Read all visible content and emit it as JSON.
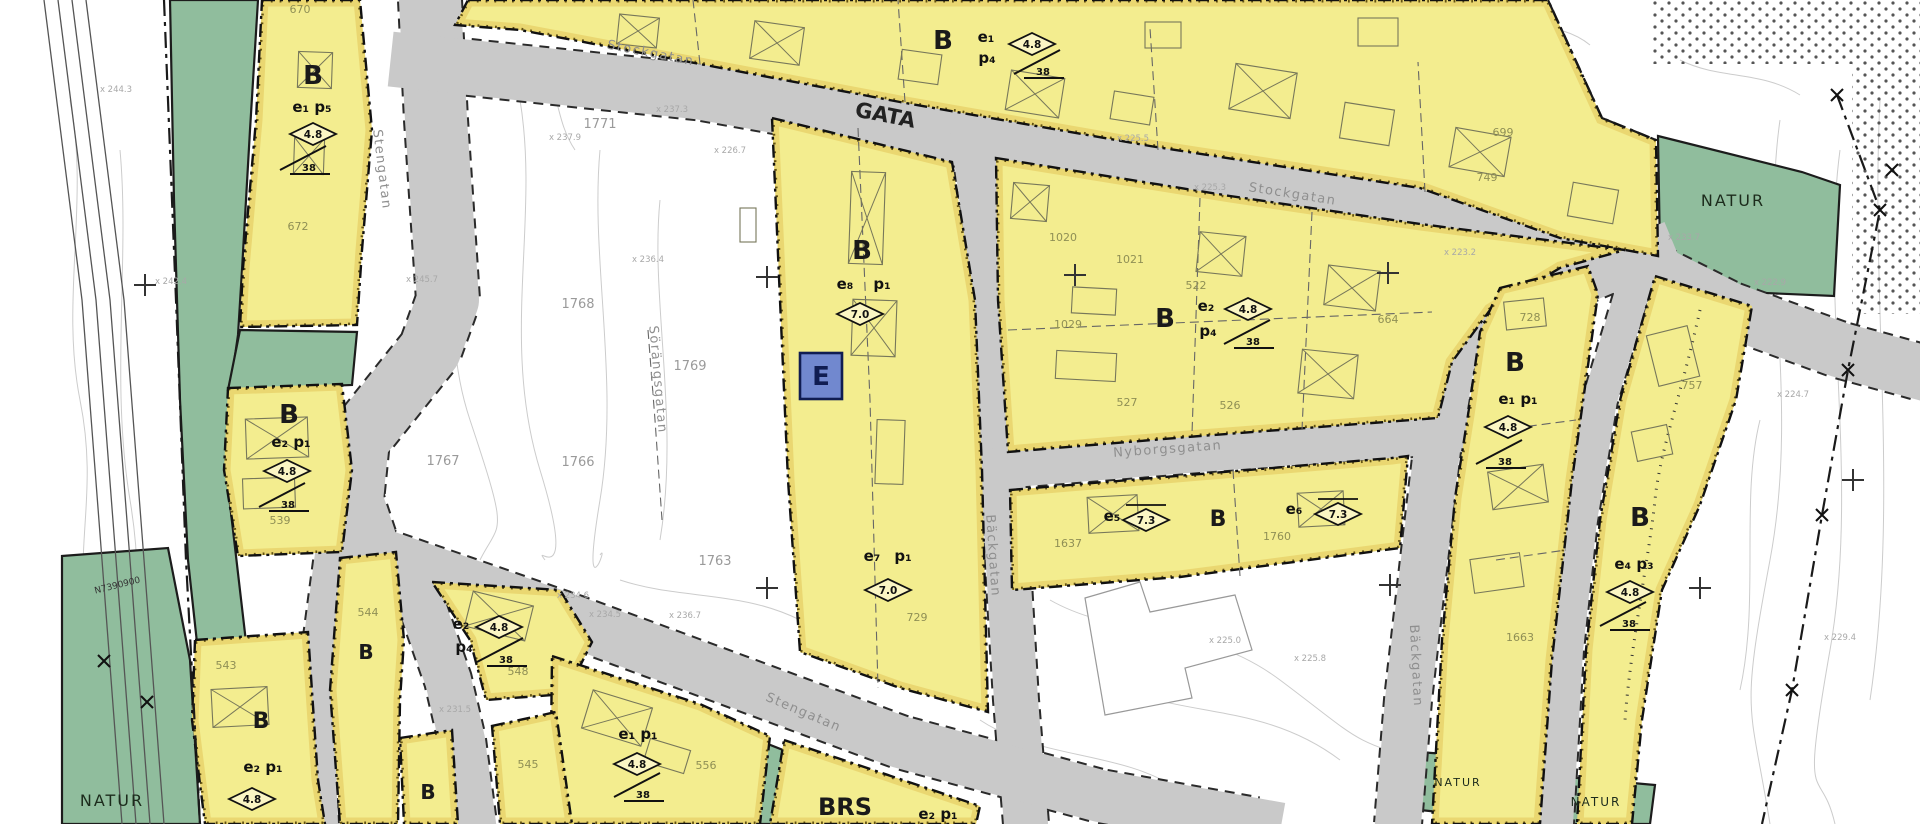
{
  "canvas": {
    "w": 1920,
    "h": 824,
    "bg": "#ffffff"
  },
  "palette": {
    "residential": "#f3ed8f",
    "nature": "#90bd9d",
    "road": "#c9c9c9",
    "road_edge": "#2a2a2a",
    "zone_border": "#111111",
    "trim_band": "#e0bd4e",
    "trim_dots": "#4a3a00",
    "tech_fill": "#7188cf",
    "tech_border": "#101d52",
    "contour": "#cccccc",
    "rail": "#555555",
    "street_label": "#8f8f8f",
    "lot_yellow": "#8f8f55",
    "lot_white": "#9a9a9a",
    "elev": "#a8a8a8",
    "zone_label": "#1a1a1a",
    "building": "#77775a"
  },
  "zones_residential": [
    {
      "id": "y1",
      "points": "262,0 360,0 372,130 362,250 357,325 240,327 243,268 256,120"
    },
    {
      "id": "y2",
      "points": "468,0 1548,0 1602,118 1656,140 1658,256 1560,238 1420,188 1150,146 900,102 700,64 520,30 455,25"
    },
    {
      "id": "y3",
      "points": "772,118 952,162 975,300 982,470 988,712 900,688 800,652 788,480 780,300"
    },
    {
      "id": "y4",
      "points": "996,158 1230,196 1420,224 1625,250 1560,268 1490,310 1452,362 1438,418 1200,436 1008,452 998,300"
    },
    {
      "id": "y5",
      "points": "1010,490 1200,474 1392,458 1408,456 1400,548 1180,577 1012,590"
    },
    {
      "id": "y6",
      "points": "1500,288 1588,266 1598,294 1572,480 1552,660 1540,824 1432,824 1442,640 1455,498 1468,415 1480,332"
    },
    {
      "id": "y7",
      "points": "1655,276 1752,306 1736,400 1700,505 1662,590 1642,720 1632,824 1577,824 1586,650 1600,520 1620,400"
    },
    {
      "id": "y8",
      "points": "228,388 342,384 352,470 342,552 238,556 224,470"
    },
    {
      "id": "y9",
      "points": "195,640 308,632 318,780 325,824 205,824 192,720"
    },
    {
      "id": "y11",
      "points": "432,582 560,590 592,642 566,694 486,700 470,640"
    },
    {
      "id": "y12",
      "points": "552,656 700,704 770,736 760,824 550,824"
    },
    {
      "id": "y13a",
      "points": "400,738 452,730 458,824 404,824"
    },
    {
      "id": "y13b",
      "points": "492,726 556,712 572,824 500,824"
    },
    {
      "id": "y14",
      "points": "340,558 396,552 404,640 400,700 398,824 340,824 330,690"
    },
    {
      "id": "brs",
      "points": "784,740 980,806 976,824 770,824"
    }
  ],
  "zones_nature": [
    {
      "id": "gstrip",
      "points": "170,0 258,0 250,130 242,270 238,335 230,390 226,470 236,556 246,642 198,652 188,560 180,400 174,200"
    },
    {
      "id": "g2",
      "points": "240,330 357,332 352,385 228,390"
    },
    {
      "id": "gbig",
      "points": "62,556 168,548 190,660 200,824 62,824"
    },
    {
      "id": "gtr",
      "points": "1658,136 1802,172 1840,185 1834,296 1742,292 1660,252"
    },
    {
      "id": "gg",
      "points": "1418,752 1502,758 1496,818 1420,810"
    },
    {
      "id": "gh",
      "points": "1545,775 1655,785 1650,824 1540,824"
    },
    {
      "id": "gw",
      "points": "745,735 788,752 778,824 690,824 702,800 737,788"
    }
  ],
  "roads": [
    {
      "id": "stengatan-n",
      "d": "M430,0 L436,120 L448,300 L430,350 L358,440 L352,500 L368,548",
      "w": 62
    },
    {
      "id": "south-1",
      "d": "M368,548 L420,600 L448,680 L462,740 L473,824",
      "w": 46
    },
    {
      "id": "south-2",
      "d": "M332,562 L315,690 L320,824",
      "w": 36
    },
    {
      "id": "stockgatan",
      "d": "M418,62 L700,92 L900,128 L1150,172 L1420,215 L1600,245 L1730,310 L1840,350 L1920,372",
      "w": 55
    },
    {
      "id": "backgatan-mid",
      "d": "M975,152 L995,300 L1002,460 L1010,600 L1016,700 L1026,824",
      "w": 44
    },
    {
      "id": "nyborgsgatan",
      "d": "M1002,468 L1200,452 L1390,438 L1462,432",
      "w": 40
    },
    {
      "id": "backgatan-e",
      "d": "M1652,252 L1560,290 L1490,308 L1452,360 L1437,450 L1424,560 L1408,700 L1398,824",
      "w": 46
    },
    {
      "id": "east-local",
      "d": "M1640,266 L1600,400 L1580,520 L1566,650 L1556,824",
      "w": 34
    },
    {
      "id": "stengatan-diag",
      "d": "M362,548 L575,622 L700,668 L900,742 L1100,796 L1255,824",
      "w": 52
    }
  ],
  "labels": {
    "zone_letters": [
      {
        "t": "B",
        "x": 313,
        "y": 75
      },
      {
        "t": "B",
        "x": 943,
        "y": 40
      },
      {
        "t": "B",
        "x": 862,
        "y": 250
      },
      {
        "t": "B",
        "x": 1165,
        "y": 318
      },
      {
        "t": "B",
        "x": 1218,
        "y": 517,
        "s": 22
      },
      {
        "t": "B",
        "x": 1515,
        "y": 362
      },
      {
        "t": "B",
        "x": 1640,
        "y": 517
      },
      {
        "t": "B",
        "x": 289,
        "y": 414
      },
      {
        "t": "B",
        "x": 261,
        "y": 719,
        "s": 22
      },
      {
        "t": "B",
        "x": 366,
        "y": 650,
        "s": 20
      },
      {
        "t": "B",
        "x": 428,
        "y": 790,
        "s": 20
      }
    ],
    "area_titles": [
      {
        "t": "NATUR",
        "x": 1733,
        "y": 206
      },
      {
        "t": "NATUR",
        "x": 112,
        "y": 806
      },
      {
        "t": "NATUR",
        "x": 1458,
        "y": 786,
        "s": 11
      },
      {
        "t": "NATUR",
        "x": 1596,
        "y": 806,
        "s": 12
      }
    ],
    "road_title": {
      "t": "GATA",
      "x": 884,
      "y": 122,
      "rot": 11
    },
    "special_title": {
      "t": "BRS",
      "x": 845,
      "y": 815
    },
    "use_codes": [
      {
        "t": "e₁ p₅",
        "x": 312,
        "y": 112
      },
      {
        "t": "e₁",
        "x": 986,
        "y": 42
      },
      {
        "t": "p₄",
        "x": 987,
        "y": 63
      },
      {
        "t": "e₈",
        "x": 845,
        "y": 289
      },
      {
        "t": "p₁",
        "x": 882,
        "y": 289
      },
      {
        "t": "e₂",
        "x": 1206,
        "y": 311
      },
      {
        "t": "p₄",
        "x": 1208,
        "y": 336
      },
      {
        "t": "e₇",
        "x": 872,
        "y": 561
      },
      {
        "t": "p₁",
        "x": 903,
        "y": 561
      },
      {
        "t": "e₅",
        "x": 1112,
        "y": 521
      },
      {
        "t": "e₆",
        "x": 1294,
        "y": 514
      },
      {
        "t": "e₁ p₁",
        "x": 1518,
        "y": 404
      },
      {
        "t": "e₄ p₃",
        "x": 1634,
        "y": 569
      },
      {
        "t": "e₂ p₁",
        "x": 291,
        "y": 447
      },
      {
        "t": "e₂ p₁",
        "x": 263,
        "y": 772
      },
      {
        "t": "e₂",
        "x": 461,
        "y": 629
      },
      {
        "t": "p₄",
        "x": 464,
        "y": 652
      },
      {
        "t": "e₁ p₁",
        "x": 638,
        "y": 739
      },
      {
        "t": "e₂ p₁",
        "x": 938,
        "y": 819
      }
    ],
    "streets": [
      {
        "t": "Stengatan",
        "x": 378,
        "y": 170,
        "rot": 83
      },
      {
        "t": "Stockgatan",
        "x": 650,
        "y": 57,
        "rot": 11
      },
      {
        "t": "Stockgatan",
        "x": 1292,
        "y": 198,
        "rot": 9
      },
      {
        "t": "Nyborgsgatan",
        "x": 1168,
        "y": 453,
        "rot": -4
      },
      {
        "t": "Bäckgatan",
        "x": 989,
        "y": 556,
        "rot": 86
      },
      {
        "t": "Stengatan",
        "x": 802,
        "y": 716,
        "rot": 23
      },
      {
        "t": "Bäckgatan",
        "x": 1412,
        "y": 666,
        "rot": 87
      },
      {
        "t": "Sörängsgatan",
        "x": 654,
        "y": 380,
        "rot": 85
      }
    ],
    "lots_plan": [
      {
        "t": "670",
        "x": 300,
        "y": 13
      },
      {
        "t": "672",
        "x": 298,
        "y": 230
      },
      {
        "t": "699",
        "x": 1503,
        "y": 136
      },
      {
        "t": "749",
        "x": 1487,
        "y": 181
      },
      {
        "t": "1020",
        "x": 1063,
        "y": 241
      },
      {
        "t": "1021",
        "x": 1130,
        "y": 263
      },
      {
        "t": "522",
        "x": 1196,
        "y": 289
      },
      {
        "t": "1029",
        "x": 1068,
        "y": 328
      },
      {
        "t": "527",
        "x": 1127,
        "y": 406
      },
      {
        "t": "526",
        "x": 1230,
        "y": 409
      },
      {
        "t": "664",
        "x": 1388,
        "y": 323
      },
      {
        "t": "1637",
        "x": 1068,
        "y": 547
      },
      {
        "t": "1760",
        "x": 1277,
        "y": 540
      },
      {
        "t": "728",
        "x": 1530,
        "y": 321
      },
      {
        "t": "1663",
        "x": 1520,
        "y": 641
      },
      {
        "t": "757",
        "x": 1692,
        "y": 389
      },
      {
        "t": "539",
        "x": 280,
        "y": 524
      },
      {
        "t": "543",
        "x": 226,
        "y": 669
      },
      {
        "t": "545",
        "x": 528,
        "y": 768
      },
      {
        "t": "548",
        "x": 518,
        "y": 675
      },
      {
        "t": "556",
        "x": 706,
        "y": 769
      },
      {
        "t": "729",
        "x": 917,
        "y": 621
      },
      {
        "t": "544",
        "x": 368,
        "y": 616
      }
    ],
    "lots_survey": [
      {
        "t": "1771",
        "x": 600,
        "y": 128
      },
      {
        "t": "1768",
        "x": 578,
        "y": 308
      },
      {
        "t": "1769",
        "x": 690,
        "y": 370
      },
      {
        "t": "1767",
        "x": 443,
        "y": 465
      },
      {
        "t": "1766",
        "x": 578,
        "y": 466
      },
      {
        "t": "1763",
        "x": 715,
        "y": 565
      }
    ],
    "elevations": [
      {
        "t": "x 244.3",
        "x": 116,
        "y": 92
      },
      {
        "t": "x 242.4",
        "x": 171,
        "y": 284
      },
      {
        "t": "x 245.7",
        "x": 422,
        "y": 282
      },
      {
        "t": "x 237.9",
        "x": 565,
        "y": 140
      },
      {
        "t": "x 237.3",
        "x": 672,
        "y": 112
      },
      {
        "t": "x 226.7",
        "x": 730,
        "y": 153
      },
      {
        "t": "x 236.4",
        "x": 648,
        "y": 262
      },
      {
        "t": "x 225.5",
        "x": 1133,
        "y": 141
      },
      {
        "t": "x 225.3",
        "x": 1210,
        "y": 190
      },
      {
        "t": "x 223.2",
        "x": 1460,
        "y": 255
      },
      {
        "t": "x 233.7",
        "x": 1684,
        "y": 240
      },
      {
        "t": "x 222.9",
        "x": 1770,
        "y": 285
      },
      {
        "t": "x 224.7",
        "x": 1793,
        "y": 397
      },
      {
        "t": "x 234.6",
        "x": 573,
        "y": 598
      },
      {
        "t": "x 234.5",
        "x": 605,
        "y": 617
      },
      {
        "t": "x 236.7",
        "x": 685,
        "y": 618
      },
      {
        "t": "x 225.0",
        "x": 1225,
        "y": 643
      },
      {
        "t": "x 225.8",
        "x": 1310,
        "y": 661
      },
      {
        "t": "x 231.5",
        "x": 455,
        "y": 712
      },
      {
        "t": "x 229.4",
        "x": 1840,
        "y": 640
      }
    ],
    "grid_ref": {
      "t": "N7390900",
      "x": 118,
      "y": 588,
      "rot": -14
    }
  },
  "symbols": {
    "tech_area": {
      "t": "E",
      "x": 800,
      "y": 353,
      "w": 42,
      "h": 46
    },
    "diamonds": [
      {
        "v": "4.8",
        "x": 313,
        "y": 134
      },
      {
        "v": "4.8",
        "x": 1032,
        "y": 44
      },
      {
        "v": "7.0",
        "x": 860,
        "y": 314
      },
      {
        "v": "4.8",
        "x": 1248,
        "y": 309
      },
      {
        "v": "7.3",
        "x": 1146,
        "y": 520,
        "bar": true
      },
      {
        "v": "7.3",
        "x": 1338,
        "y": 514,
        "bar": true
      },
      {
        "v": "4.8",
        "x": 1508,
        "y": 427
      },
      {
        "v": "4.8",
        "x": 1630,
        "y": 592
      },
      {
        "v": "4.8",
        "x": 287,
        "y": 471
      },
      {
        "v": "4.8",
        "x": 252,
        "y": 799
      },
      {
        "v": "4.8",
        "x": 499,
        "y": 627
      },
      {
        "v": "4.8",
        "x": 637,
        "y": 764
      },
      {
        "v": "7.0",
        "x": 888,
        "y": 590
      }
    ],
    "slopes": [
      {
        "v": "38",
        "x": 306,
        "y": 160
      },
      {
        "v": "38",
        "x": 1040,
        "y": 64
      },
      {
        "v": "38",
        "x": 1250,
        "y": 334
      },
      {
        "v": "38",
        "x": 1502,
        "y": 454
      },
      {
        "v": "38",
        "x": 285,
        "y": 497
      },
      {
        "v": "38",
        "x": 503,
        "y": 652
      },
      {
        "v": "38",
        "x": 640,
        "y": 787
      },
      {
        "v": "38",
        "x": 1626,
        "y": 616
      }
    ],
    "crosses": [
      [
        145,
        285
      ],
      [
        767,
        277
      ],
      [
        1075,
        275
      ],
      [
        1388,
        273
      ],
      [
        767,
        588
      ],
      [
        1700,
        588
      ],
      [
        1853,
        480
      ],
      [
        1390,
        585
      ]
    ],
    "boundary_marks": [
      [
        104,
        661
      ],
      [
        147,
        702
      ],
      [
        1892,
        170
      ],
      [
        1837,
        95
      ],
      [
        1880,
        210
      ],
      [
        1848,
        370
      ],
      [
        1822,
        515
      ],
      [
        1792,
        690
      ]
    ]
  },
  "decor": {
    "contours": [
      "M70,100 C90,200 60,300 80,400 S70,550 90,650 S80,760 95,824",
      "M120,150 C130,260 110,380 130,500 S120,650 135,760",
      "M450,120 C480,200 430,300 470,420 S500,520 480,560",
      "M520,100 C540,220 500,340 540,470 S530,540 545,560",
      "M600,150 C590,260 620,380 600,500 S610,540 600,555",
      "M660,200 C650,300 680,420 660,540",
      "M540,60 C560,90 555,120 575,150",
      "M1780,120 C1760,260 1800,400 1770,560 S1750,700 1770,824",
      "M1840,150 C1820,300 1860,480 1830,650 S1820,760 1835,824",
      "M1880,100 C1870,300 1900,500 1870,700",
      "M1760,420 C1740,500 1760,600 1740,690",
      "M1050,600 C1120,640 1200,620 1280,680 S1350,740 1420,760",
      "M1100,680 C1180,720 1260,700 1340,760",
      "M980,720 C1040,760 1120,750 1180,790",
      "M620,580 C680,600 740,590 800,620",
      "M1680,60 C1720,80 1760,70 1800,95",
      "M1480,10 C1520,30 1560,20 1590,45"
    ],
    "dot_areas": [
      [
        1650,
        0,
        270,
        64
      ],
      [
        1852,
        62,
        68,
        252
      ]
    ],
    "rail_lines": [
      "M44,0 L82,300 L102,560 L122,824",
      "M58,0 L96,300 L116,560 L136,824",
      "M72,0 L110,300 L130,560 L150,824",
      "M86,0 L124,300 L144,560 L164,824"
    ],
    "boundary_lines": [
      "M164,0 L176,300 L186,560 L200,824",
      "M1837,95 L1880,210 L1848,370 L1822,515 L1792,690 L1762,824",
      "M1548,0 L1602,118 L1656,140"
    ],
    "dividers": [
      "M700,64 L693,0",
      "M905,102 L898,0",
      "M1158,150 L1150,28",
      "M1425,192 L1418,62",
      "M1200,198 L1192,434",
      "M1312,212 L1302,430",
      "M1008,330 L1432,312",
      "M858,128 L870,400 L878,688",
      "M1233,470 L1240,576",
      "M1500,430 L1576,420",
      "M1496,560 L1566,550",
      "M648,330 L655,420 L662,520"
    ],
    "meander": "M1700,310 C1680,400 1660,450 1655,500 S1630,650 1625,720",
    "big_building": "M1085,598 L1140,582 L1150,612 L1235,595 L1252,650 L1185,668 L1192,698 L1105,715 Z",
    "buildings": [
      [
        298,
        52,
        34,
        36,
        2,
        1
      ],
      [
        294,
        138,
        30,
        36,
        2,
        1
      ],
      [
        618,
        16,
        40,
        30,
        6,
        1
      ],
      [
        752,
        24,
        50,
        38,
        8,
        1
      ],
      [
        900,
        52,
        40,
        30,
        8,
        0
      ],
      [
        1008,
        74,
        54,
        40,
        9,
        1
      ],
      [
        1112,
        94,
        40,
        28,
        9,
        0
      ],
      [
        1232,
        68,
        62,
        46,
        9,
        1
      ],
      [
        1342,
        106,
        50,
        36,
        9,
        0
      ],
      [
        1452,
        132,
        56,
        40,
        10,
        1
      ],
      [
        1570,
        186,
        46,
        34,
        10,
        0
      ],
      [
        1145,
        22,
        36,
        26,
        0,
        0
      ],
      [
        1358,
        18,
        40,
        28,
        0,
        0
      ],
      [
        850,
        172,
        34,
        92,
        2,
        1
      ],
      [
        852,
        300,
        44,
        56,
        2,
        1
      ],
      [
        740,
        208,
        16,
        34,
        0,
        0
      ],
      [
        876,
        420,
        28,
        64,
        2,
        0
      ],
      [
        1012,
        184,
        36,
        36,
        5,
        1
      ],
      [
        1198,
        234,
        46,
        40,
        6,
        1
      ],
      [
        1326,
        268,
        52,
        40,
        7,
        1
      ],
      [
        1072,
        288,
        44,
        26,
        3,
        0
      ],
      [
        1056,
        352,
        60,
        28,
        3,
        0
      ],
      [
        1300,
        352,
        56,
        44,
        6,
        1
      ],
      [
        1088,
        496,
        50,
        36,
        -3,
        1
      ],
      [
        1298,
        492,
        46,
        34,
        -3,
        1
      ],
      [
        1505,
        300,
        40,
        28,
        -6,
        0
      ],
      [
        1490,
        468,
        56,
        38,
        -8,
        1
      ],
      [
        1472,
        556,
        50,
        34,
        -8,
        0
      ],
      [
        1652,
        330,
        42,
        52,
        -14,
        0
      ],
      [
        1634,
        428,
        36,
        30,
        -12,
        0
      ],
      [
        246,
        418,
        62,
        40,
        -2,
        1
      ],
      [
        243,
        478,
        52,
        30,
        -2,
        0
      ],
      [
        212,
        688,
        56,
        38,
        -3,
        1
      ],
      [
        468,
        598,
        62,
        36,
        14,
        1
      ],
      [
        586,
        698,
        62,
        40,
        17,
        1
      ],
      [
        646,
        744,
        42,
        24,
        17,
        0
      ]
    ]
  }
}
